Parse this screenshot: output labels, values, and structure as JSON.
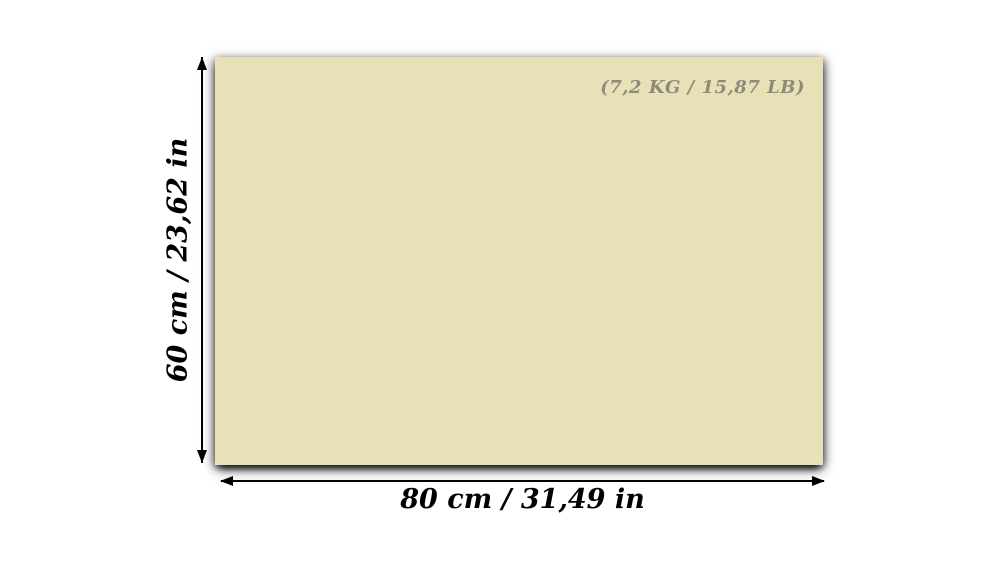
{
  "diagram": {
    "weight_label": "(7,2 KG / 15,87 LB)",
    "height_label": "60 cm / 23,62 in",
    "width_label": "80 cm / 31,49 in",
    "board_color": "#e8e0b6",
    "background_color": "#ffffff",
    "dimension_text_color": "#000000",
    "weight_text_color": "#8e8b7a"
  }
}
